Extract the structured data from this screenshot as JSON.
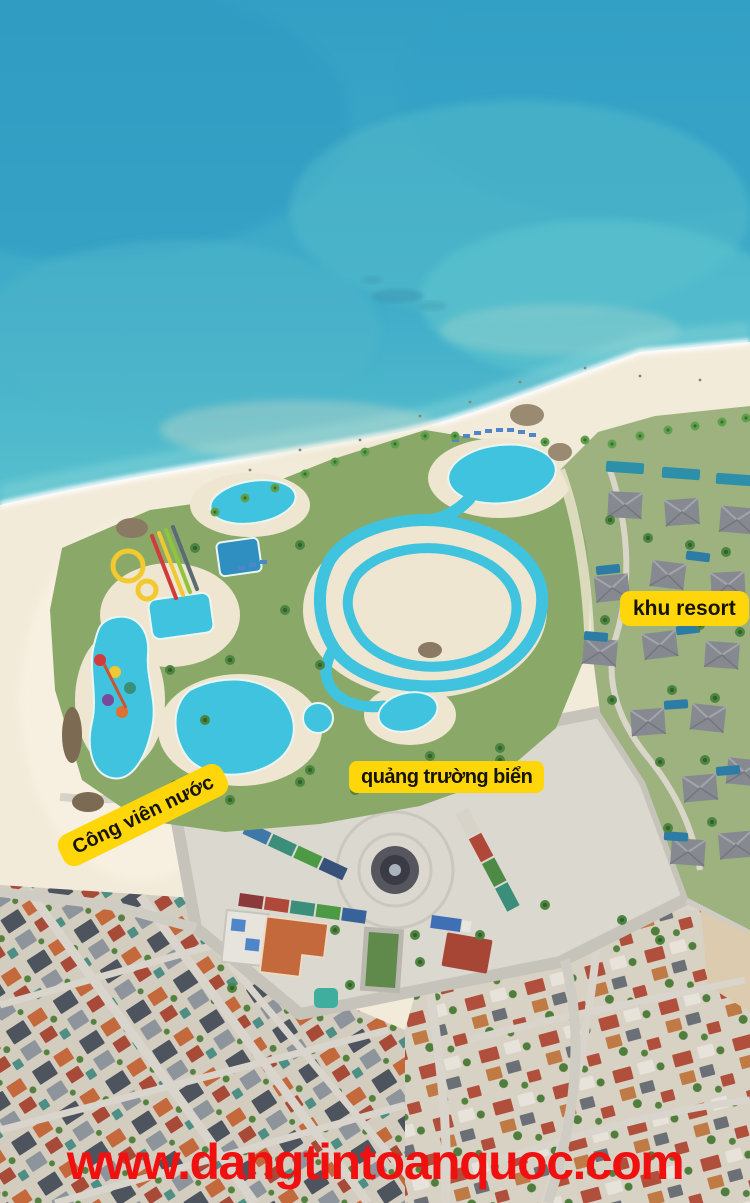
{
  "scene": {
    "colors": {
      "ocean_top": "#339fc4",
      "ocean_mid": "#41adc9",
      "ocean_shallow": "#5ec6cf",
      "sand": "#f3ebda",
      "park_green": "#8aa968",
      "pool": "#3fc3de",
      "villa_roof": "#868a90",
      "villa_pool": "#2c7ca6",
      "plaza": "#dbd8cf",
      "road": "#c6c3bb",
      "roof_orange": "#c4693c",
      "roof_red": "#b0503c",
      "roof_dark": "#4e545e",
      "label_bg": "#ffd60a",
      "label_text": "#161300",
      "watermark": "#f01010"
    }
  },
  "annotations": {
    "water_park_label": "Công viên nước",
    "beach_square_label": "quảng trường biển",
    "resort_label": "khu resort"
  },
  "watermark": {
    "text": "www.dangtintoanquoc.com"
  }
}
